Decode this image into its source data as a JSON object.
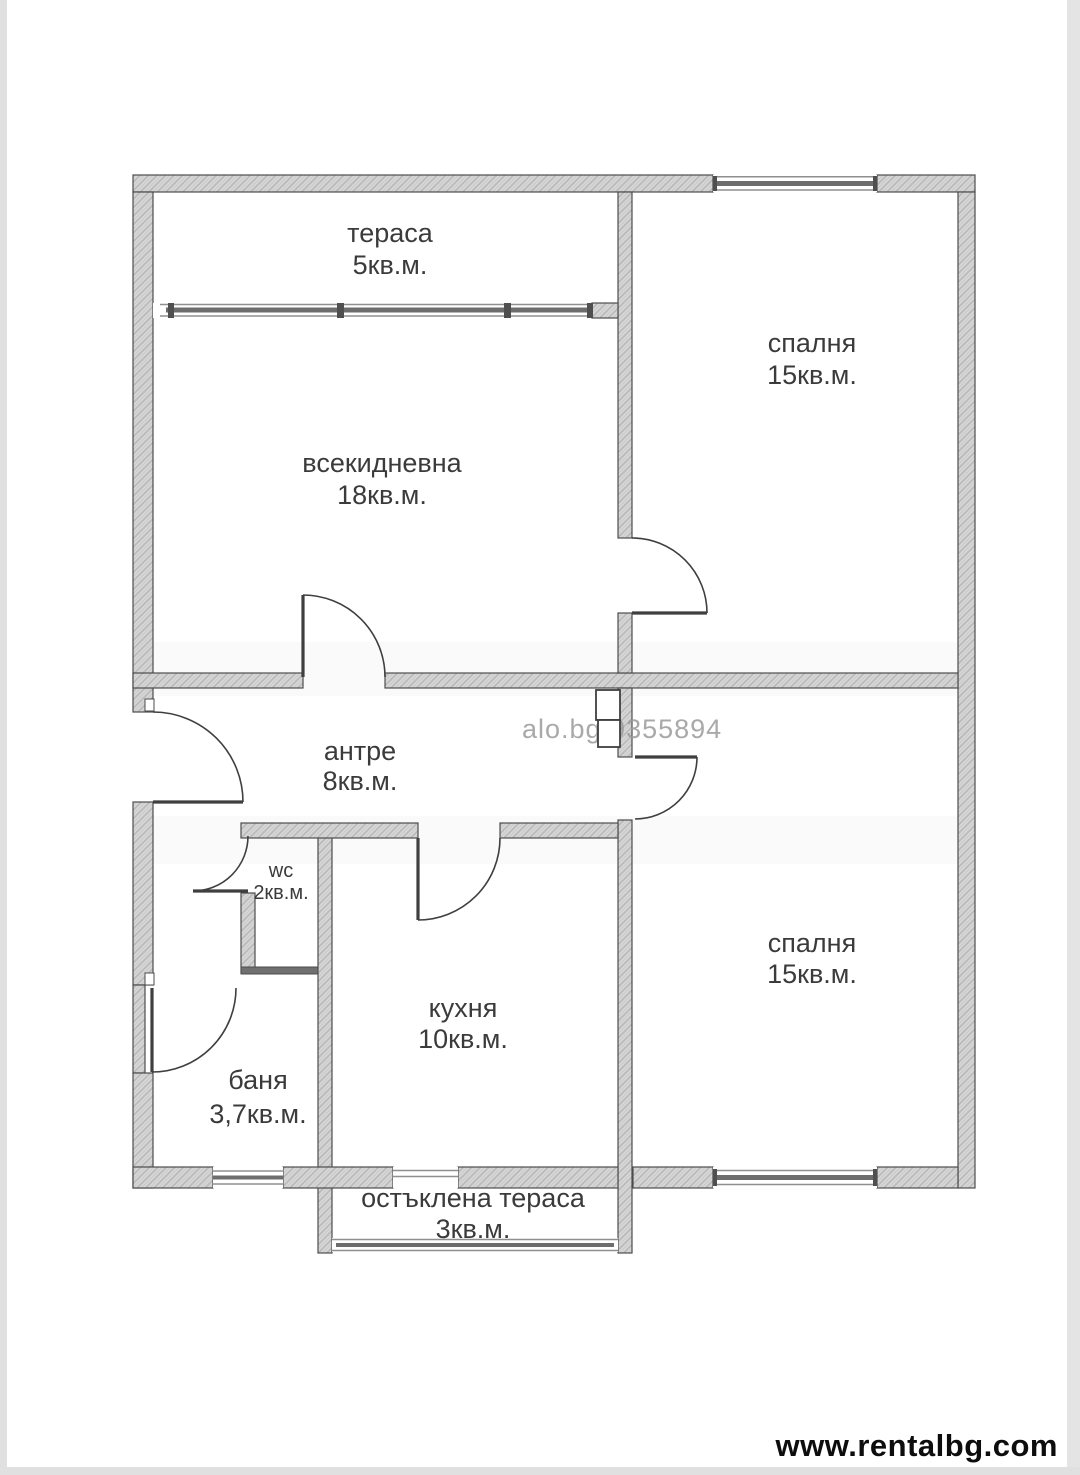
{
  "page": {
    "watermark": "alo.bg 9355894",
    "footer_url": "www.rentalbg.com"
  },
  "rooms": [
    {
      "key": "terrace",
      "name": "тераса",
      "area": "5кв.м."
    },
    {
      "key": "bedroom-top",
      "name": "спалня",
      "area": "15кв.м."
    },
    {
      "key": "living-room",
      "name": "всекидневна",
      "area": "18кв.м."
    },
    {
      "key": "entry-hall",
      "name": "антре",
      "area": "8кв.м."
    },
    {
      "key": "wc",
      "name": "wc",
      "area": "2кв.м."
    },
    {
      "key": "kitchen",
      "name": "кухня",
      "area": "10кв.м."
    },
    {
      "key": "bathroom",
      "name": "баня",
      "area": "3,7кв.м."
    },
    {
      "key": "bedroom-bottom",
      "name": "спалня",
      "area": "15кв.м."
    },
    {
      "key": "glazed-terrace",
      "name": "остъклена тераса",
      "area": "3кв.м."
    }
  ]
}
